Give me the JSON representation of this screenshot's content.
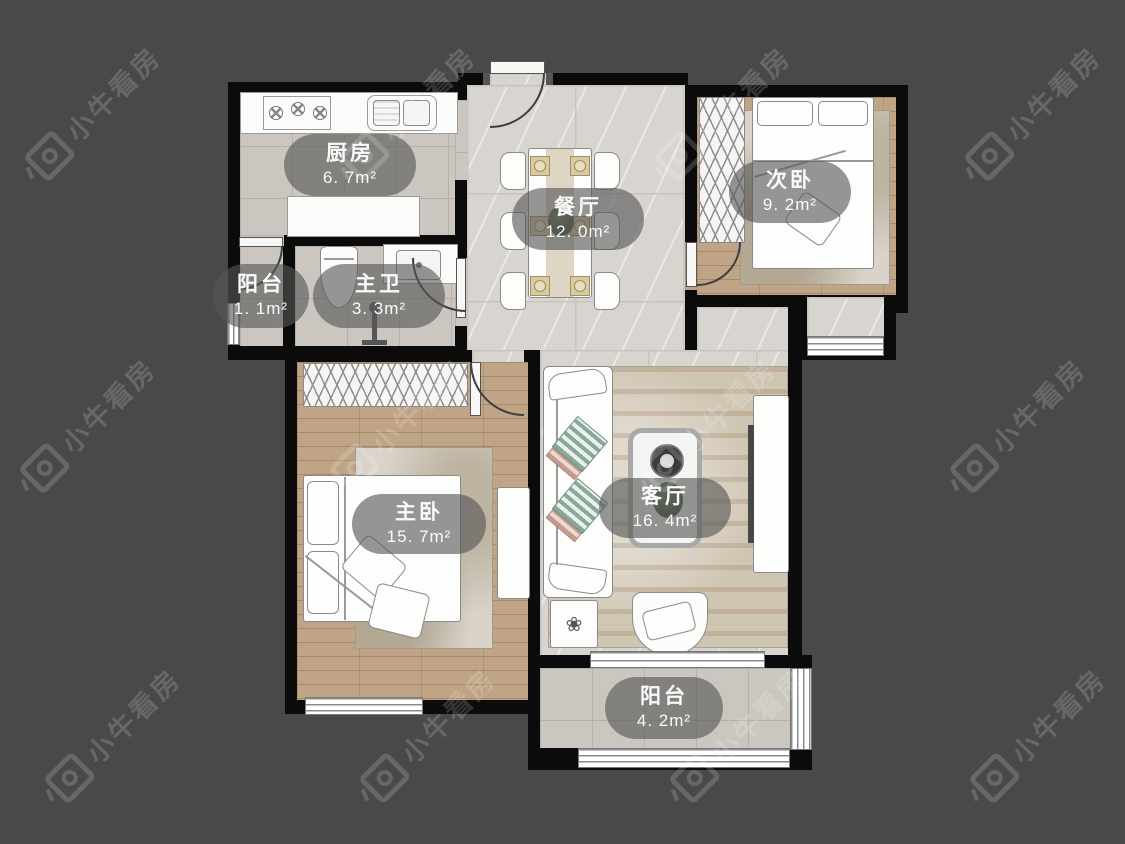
{
  "watermark": {
    "text": "小牛看房"
  },
  "icons": {
    "flower": "❀"
  },
  "floorplan": {
    "rooms": [
      {
        "name": "厨房",
        "area": "6. 7m²"
      },
      {
        "name": "餐厅",
        "area": "12. 0m²"
      },
      {
        "name": "次卧",
        "area": "9. 2m²"
      },
      {
        "name": "阳台",
        "area": "1. 1m²"
      },
      {
        "name": "主卫",
        "area": "3. 3m²"
      },
      {
        "name": "主卧",
        "area": "15. 7m²"
      },
      {
        "name": "客厅",
        "area": "16. 4m²"
      },
      {
        "name": "阳台",
        "area": "4. 2m²"
      }
    ],
    "colors": {
      "background": "#494949",
      "wall": "#0b0b0b",
      "wood_floor": "#c0a486",
      "marble_floor": "#d8d5d1",
      "tile_floor": "#cbc7c0",
      "label_bg": "rgba(86,86,86,0.62)"
    }
  }
}
